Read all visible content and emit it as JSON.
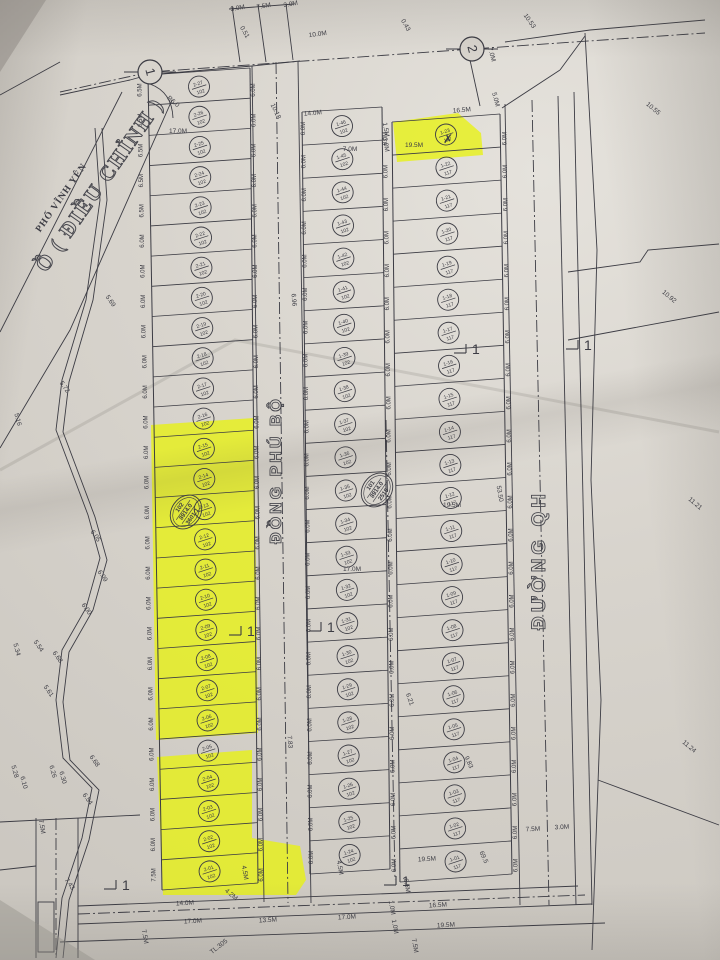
{
  "colors": {
    "paper": "#d8d4cd",
    "ink": "#3c3c44",
    "highlight": "#e8f211"
  },
  "title": {
    "small": "PHỐ VĨNH YÊN",
    "big": "Ồ ( ĐIỀU CHỈNH )"
  },
  "roads": {
    "middle": "ĐỒNG PHÚ BỘ",
    "right": "ĐƯỜNG QH"
  },
  "stations": [
    "1",
    "2"
  ],
  "section_mark_label": "1",
  "parcels": [
    {
      "lines": [
        "102",
        "8914.0",
        "3601.1"
      ]
    },
    {
      "lines": [
        "101",
        "8914.0",
        "2515"
      ]
    }
  ],
  "blocks": {
    "left": {
      "area": "102",
      "plots": [
        "2-27",
        "2-26",
        "2-25",
        "2-24",
        "2-23",
        "2-22",
        "2-21",
        "2-20",
        "2-19",
        "2-18",
        "2-17",
        "2-16",
        "2-15",
        "2-14",
        "2-13",
        "2-12",
        "2-11",
        "2-10",
        "2-09",
        "2-08",
        "2-07",
        "2-06",
        "2-05",
        "2-04",
        "2-03",
        "2-02",
        "2-01"
      ]
    },
    "middle": {
      "area": "102",
      "plots": [
        "1-46",
        "1-45",
        "1-44",
        "1-43",
        "1-42",
        "1-41",
        "1-40",
        "1-39",
        "1-38",
        "1-37",
        "1-36",
        "1-35",
        "1-34",
        "1-33",
        "1-32",
        "1-31",
        "1-30",
        "1-29",
        "1-28",
        "1-27",
        "1-26",
        "1-25",
        "1-24"
      ]
    },
    "right": {
      "area": "117",
      "plots": [
        "1-23",
        "1-22",
        "1-21",
        "1-20",
        "1-19",
        "1-18",
        "1-17",
        "1-16",
        "1-15",
        "1-14",
        "1-13",
        "1-12",
        "1-11",
        "1-10",
        "1-09",
        "1-08",
        "1-07",
        "1-06",
        "1-05",
        "1-04",
        "1-03",
        "1-02",
        "1-01"
      ]
    }
  },
  "dim_columns": {
    "left_outer": [
      "6.5M",
      "6.5M",
      "6.5M",
      "6.5M",
      "6.5M",
      "6.0M",
      "6.0M",
      "6.0M",
      "6.0M",
      "6.0M",
      "6.0M",
      "6.0M",
      "6.0M",
      "6.0M",
      "6.0M",
      "6.0M",
      "6.0M",
      "6.0M",
      "6.0M",
      "6.0M",
      "6.0M",
      "6.0M",
      "6.0M",
      "6.0M",
      "6.0M",
      "6.0M",
      "7.5M"
    ],
    "left_inner": [
      "6.0M",
      "6.0M",
      "6.0M",
      "6.0M",
      "6.0M",
      "6.0M",
      "6.0M",
      "6.0M",
      "6.0M",
      "6.0M",
      "6.0M",
      "6.0M",
      "6.0M",
      "6.0M",
      "6.0M",
      "6.0M",
      "6.0M",
      "6.0M",
      "6.0M",
      "6.0M",
      "6.0M",
      "6.0M",
      "6.0M",
      "6.0M",
      "6.0M",
      "6.0M",
      "6.0M"
    ],
    "middle_left": [
      "6.0M",
      "6.0M",
      "6.0M",
      "6.0M",
      "6.0M",
      "6.0M",
      "6.0M",
      "6.0M",
      "6.0M",
      "6.0M",
      "6.0M",
      "6.0M",
      "6.0M",
      "6.0M",
      "6.0M",
      "6.0M",
      "6.0M",
      "6.0M",
      "6.0M",
      "6.0M",
      "6.0M",
      "6.0M",
      "6.0M"
    ],
    "right_left": [
      "6.0M",
      "6.0M",
      "6.0M",
      "6.0M",
      "6.0M",
      "6.0M",
      "6.0M",
      "6.0M",
      "6.0M",
      "6.0M",
      "6.0M",
      "6.0M",
      "6.0M",
      "6.0M",
      "6.0M",
      "6.0M",
      "6.0M",
      "6.0M",
      "6.0M",
      "6.0M",
      "6.0M",
      "6.0M",
      "6.0M"
    ],
    "right_outer": [
      "6.0M",
      "6.0M",
      "6.0M",
      "6.0M",
      "6.0M",
      "6.0M",
      "6.0M",
      "6.0M",
      "6.0M",
      "6.0M",
      "6.0M",
      "6.0M",
      "6.0M",
      "6.0M",
      "6.0M",
      "6.0M",
      "6.0M",
      "6.0M",
      "6.0M",
      "6.0M",
      "6.0M",
      "6.0M",
      "6.0M"
    ]
  },
  "annotations": [
    {
      "t": "3.0M",
      "x": 238,
      "y": 10,
      "r": -10
    },
    {
      "t": "7.5M",
      "x": 264,
      "y": 8,
      "r": -10
    },
    {
      "t": "3.0M",
      "x": 291,
      "y": 6,
      "r": -10
    },
    {
      "t": "10.0M",
      "x": 318,
      "y": 36,
      "r": -8
    },
    {
      "t": "0.51",
      "x": 243,
      "y": 33,
      "r": 60
    },
    {
      "t": "0.43",
      "x": 404,
      "y": 26,
      "r": 60
    },
    {
      "t": "10.53",
      "x": 528,
      "y": 22,
      "r": 55
    },
    {
      "t": "10.55",
      "x": 652,
      "y": 110,
      "r": 40
    },
    {
      "t": "10.92",
      "x": 668,
      "y": 298,
      "r": 40
    },
    {
      "t": "11.21",
      "x": 694,
      "y": 505,
      "r": 40
    },
    {
      "t": "11.24",
      "x": 688,
      "y": 748,
      "r": 40
    },
    {
      "t": "10.18",
      "x": 274,
      "y": 112,
      "r": 65
    },
    {
      "t": "R6.0",
      "x": 172,
      "y": 103,
      "r": 40
    },
    {
      "t": "16.5M",
      "x": 462,
      "y": 112,
      "r": -5
    },
    {
      "t": "14.0M",
      "x": 313,
      "y": 115,
      "r": -5
    },
    {
      "t": "19.5M",
      "x": 414,
      "y": 147,
      "r": 0
    },
    {
      "t": "1.5M",
      "x": 384,
      "y": 130,
      "r": 80
    },
    {
      "t": "3.0M",
      "x": 384,
      "y": 145,
      "r": 80
    },
    {
      "t": "7.0M",
      "x": 350,
      "y": 151,
      "r": 0
    },
    {
      "t": "17.0M",
      "x": 178,
      "y": 133,
      "r": 0
    },
    {
      "t": "17.0M",
      "x": 352,
      "y": 571,
      "r": 0
    },
    {
      "t": "19.5M",
      "x": 452,
      "y": 507,
      "r": 0
    },
    {
      "t": "7.0M",
      "x": 490,
      "y": 55,
      "r": 75
    },
    {
      "t": "5.0M",
      "x": 494,
      "y": 100,
      "r": 75
    },
    {
      "t": "7.83",
      "x": 288,
      "y": 742,
      "r": 85
    },
    {
      "t": "6.96",
      "x": 292,
      "y": 300,
      "r": 85
    },
    {
      "t": "53.50",
      "x": 498,
      "y": 494,
      "r": 80
    },
    {
      "t": "5.69",
      "x": 109,
      "y": 302,
      "r": 55
    },
    {
      "t": "5.72",
      "x": 63,
      "y": 388,
      "r": 55
    },
    {
      "t": "5.16",
      "x": 16,
      "y": 420,
      "r": 75
    },
    {
      "t": "6.05",
      "x": 94,
      "y": 537,
      "r": 55
    },
    {
      "t": "6.09",
      "x": 101,
      "y": 577,
      "r": 55
    },
    {
      "t": "6.00",
      "x": 85,
      "y": 610,
      "r": 55
    },
    {
      "t": "5.54",
      "x": 37,
      "y": 647,
      "r": 55
    },
    {
      "t": "6.68",
      "x": 56,
      "y": 658,
      "r": 55
    },
    {
      "t": "5.61",
      "x": 47,
      "y": 692,
      "r": 55
    },
    {
      "t": "6.26",
      "x": 51,
      "y": 772,
      "r": 75
    },
    {
      "t": "6.30",
      "x": 61,
      "y": 778,
      "r": 75
    },
    {
      "t": "6.68",
      "x": 93,
      "y": 762,
      "r": 55
    },
    {
      "t": "6.54",
      "x": 86,
      "y": 800,
      "r": 55
    },
    {
      "t": "5.34",
      "x": 15,
      "y": 650,
      "r": 75
    },
    {
      "t": "5.28",
      "x": 13,
      "y": 772,
      "r": 75
    },
    {
      "t": "6.10",
      "x": 22,
      "y": 783,
      "r": 75
    },
    {
      "t": "7.43",
      "x": 68,
      "y": 885,
      "r": 55
    },
    {
      "t": "9.83",
      "x": 467,
      "y": 763,
      "r": 65
    },
    {
      "t": "69.5",
      "x": 482,
      "y": 858,
      "r": 65
    },
    {
      "t": "6.21",
      "x": 408,
      "y": 700,
      "r": 70
    },
    {
      "t": "14.0M",
      "x": 185,
      "y": 905,
      "r": -3
    },
    {
      "t": "17.0M",
      "x": 193,
      "y": 923,
      "r": -3
    },
    {
      "t": "13.5M",
      "x": 268,
      "y": 922,
      "r": -3
    },
    {
      "t": "17.0M",
      "x": 347,
      "y": 919,
      "r": -3
    },
    {
      "t": "7.5M",
      "x": 143,
      "y": 937,
      "r": 80
    },
    {
      "t": "7.5M",
      "x": 40,
      "y": 827,
      "r": 80
    },
    {
      "t": "4.5M",
      "x": 243,
      "y": 873,
      "r": 80
    },
    {
      "t": "4.2M",
      "x": 230,
      "y": 896,
      "r": 40
    },
    {
      "t": "4.5M",
      "x": 338,
      "y": 868,
      "r": 80
    },
    {
      "t": "19.5M",
      "x": 427,
      "y": 861,
      "r": -3
    },
    {
      "t": "16.5M",
      "x": 438,
      "y": 907,
      "r": -3
    },
    {
      "t": "19.5M",
      "x": 446,
      "y": 927,
      "r": -3
    },
    {
      "t": "1.0M",
      "x": 390,
      "y": 908,
      "r": 80
    },
    {
      "t": "1.0M",
      "x": 393,
      "y": 927,
      "r": 80
    },
    {
      "t": "7.5M",
      "x": 413,
      "y": 946,
      "r": 80
    },
    {
      "t": "7.5M",
      "x": 533,
      "y": 831,
      "r": -3
    },
    {
      "t": "3.0M",
      "x": 562,
      "y": 829,
      "r": -3
    },
    {
      "t": "6.5M",
      "x": 405,
      "y": 886,
      "r": 80
    },
    {
      "t": "TL.305",
      "x": 220,
      "y": 948,
      "r": -38
    },
    {
      "t": "✗",
      "x": 448,
      "y": 143,
      "r": 0,
      "s": 12
    }
  ]
}
